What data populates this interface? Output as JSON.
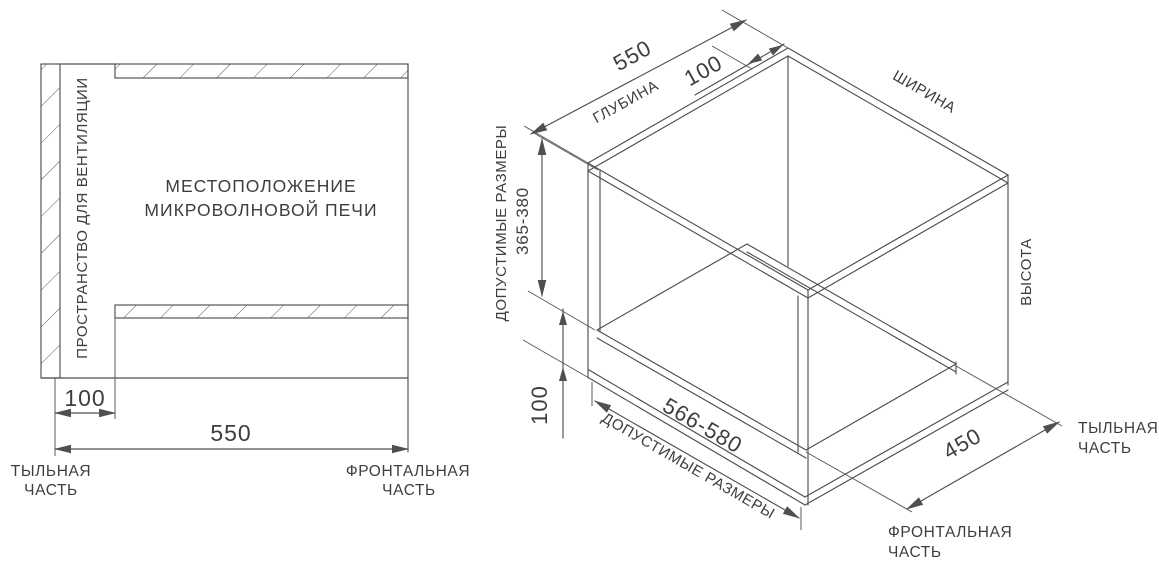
{
  "colors": {
    "line": "#4f4f4f",
    "text": "#3e3e3e",
    "background": "#ffffff"
  },
  "left_figure": {
    "ventilation_label": "ПРОСТРАНСТВО ДЛЯ ВЕНТИЛЯЦИИ",
    "location_line1": "МЕСТОПОЛОЖЕНИЕ",
    "location_line2": "МИКРОВОЛНОВОЙ ПЕЧИ",
    "dim_ventilation_gap": "100",
    "dim_depth": "550",
    "rear_label_line1": "ТЫЛЬНАЯ",
    "rear_label_line2": "ЧАСТЬ",
    "front_label_line1": "ФРОНТАЛЬНАЯ",
    "front_label_line2": "ЧАСТЬ"
  },
  "right_figure": {
    "dim_depth": "550",
    "depth_axis_label": "ГЛУБИНА",
    "dim_ventilation_gap": "100",
    "width_axis_label": "ШИРИНА",
    "height_axis_label": "ВЫСОТА",
    "allowed_sizes_label_height": "ДОПУСТИМЫЕ РАЗМЕРЫ",
    "dim_height_range": "365-380",
    "dim_bottom_gap": "100",
    "dim_width_range": "566-580",
    "allowed_sizes_label_width": "ДОПУСТИМЫЕ РАЗМЕРЫ",
    "dim_shelf_depth": "450",
    "rear_label_line1": "ТЫЛЬНАЯ",
    "rear_label_line2": "ЧАСТЬ",
    "front_label_line1": "ФРОНТАЛЬНАЯ",
    "front_label_line2": "ЧАСТЬ"
  }
}
